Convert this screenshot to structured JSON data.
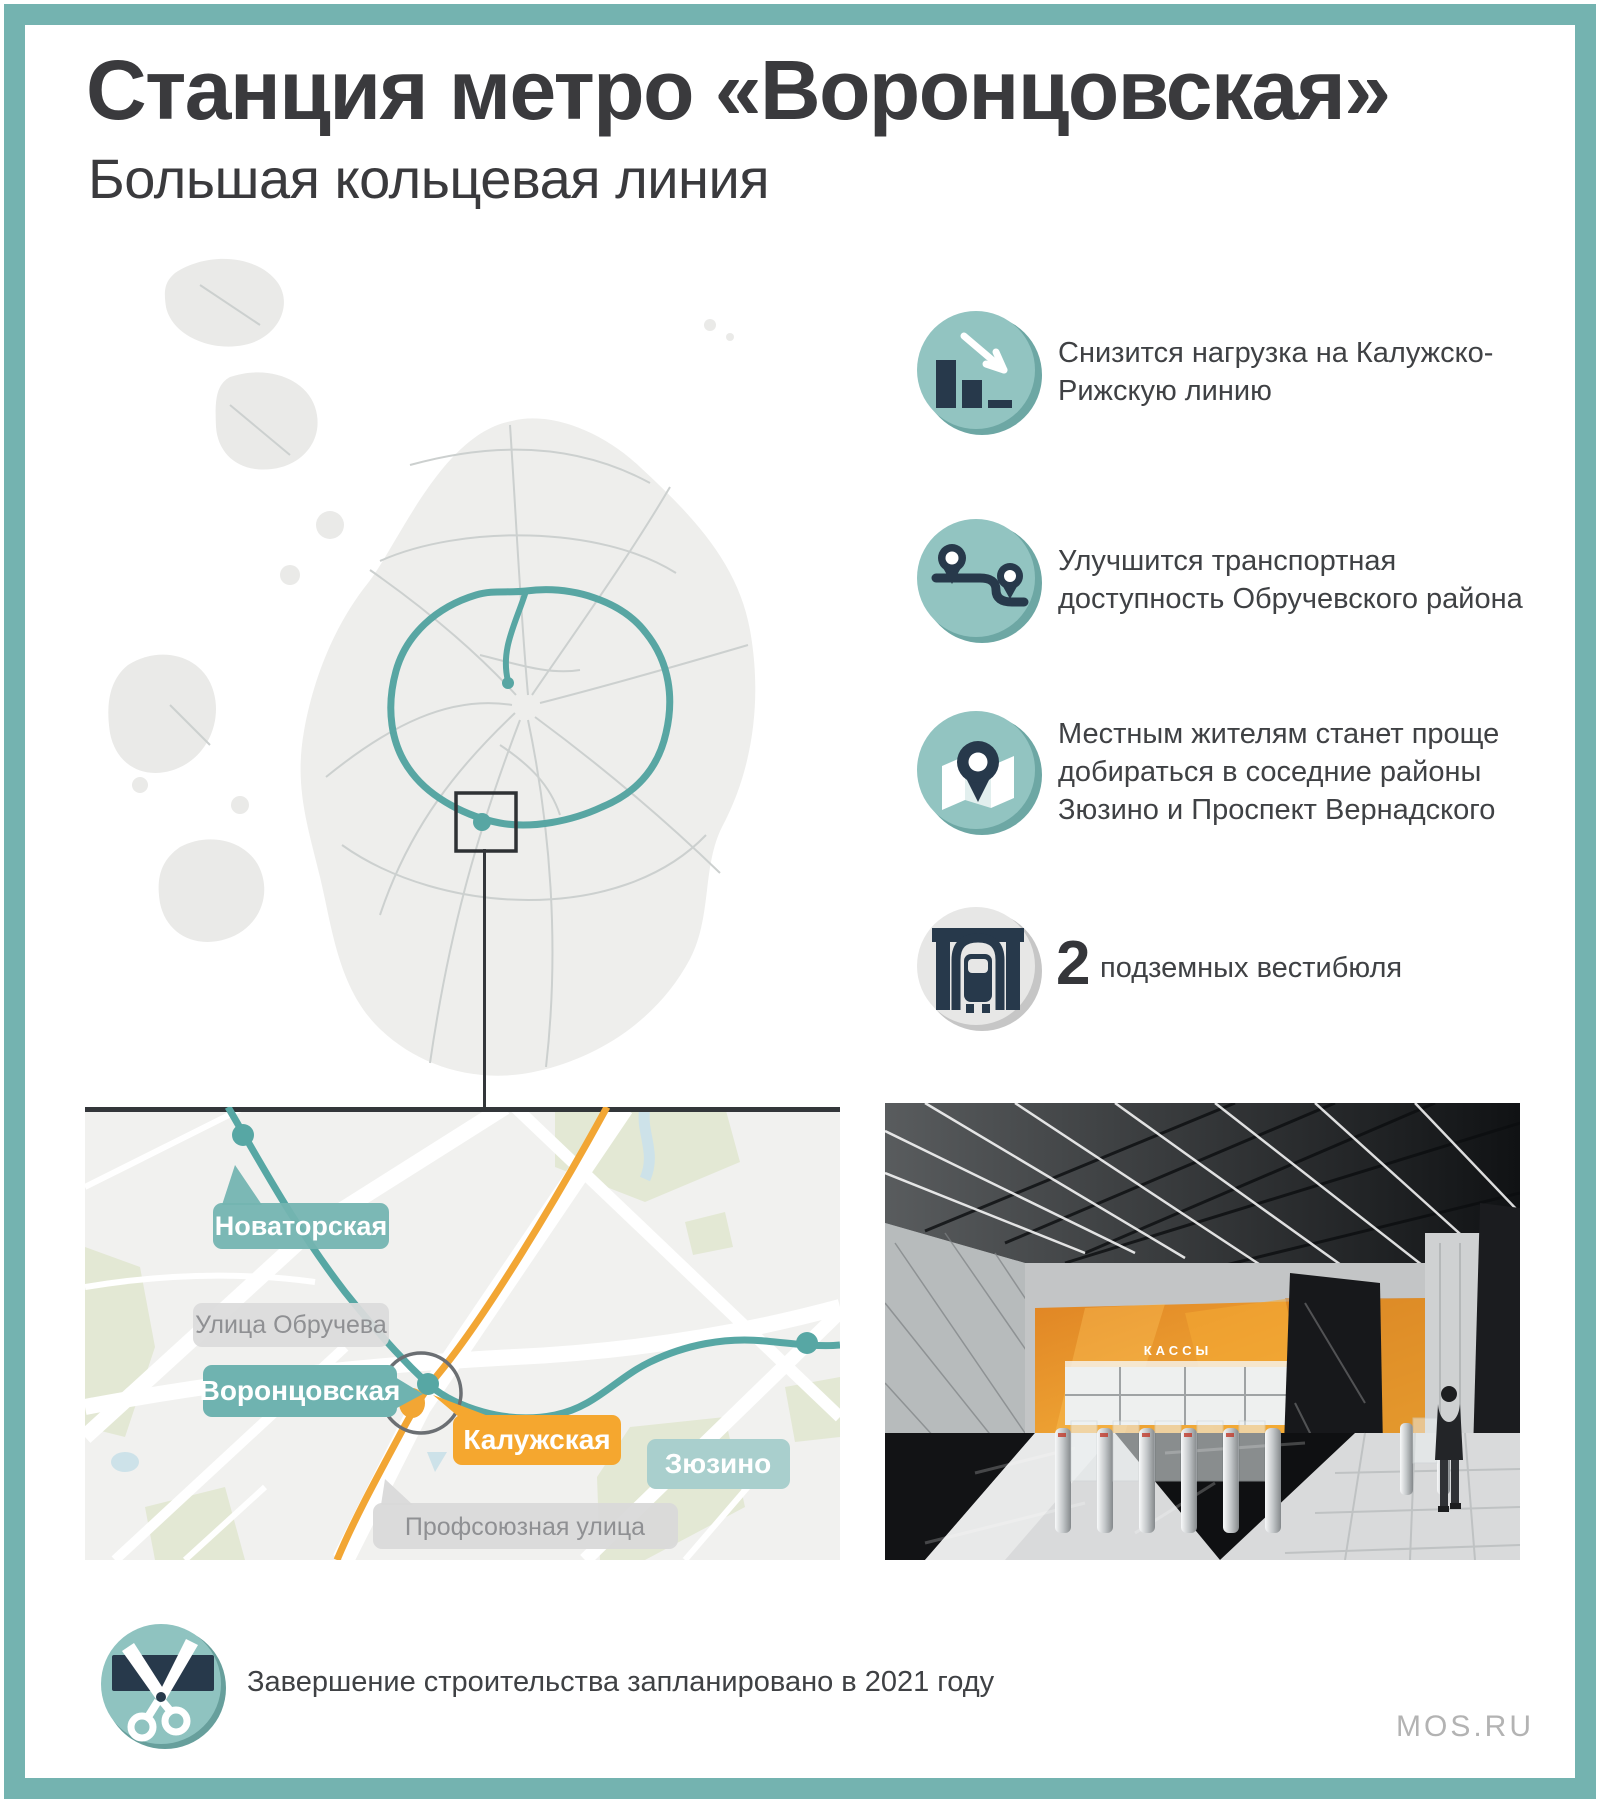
{
  "header": {
    "title": "Станция метро «Воронцовская»",
    "subtitle": "Большая кольцевая линия"
  },
  "colors": {
    "accent_teal": "#74b3b0",
    "line_teal": "#58a6a3",
    "line_orange": "#f2a634",
    "icon_navy": "#27394b",
    "label_gray": "#d9d9d9",
    "text_dark": "#3a3a3d"
  },
  "benefits": [
    {
      "icon": "bar-chart-decline-icon",
      "lines": [
        "Снизится нагрузка на Калужско-",
        "Рижскую линию"
      ]
    },
    {
      "icon": "route-pins-icon",
      "lines": [
        "Улучшится транспортная",
        "доступность Обручевского района"
      ]
    },
    {
      "icon": "map-pin-icon",
      "lines": [
        "Местным жителям станет проще",
        "добираться в соседние районы",
        "Зюзино и Проспект Вернадского"
      ]
    },
    {
      "icon": "tunnel-train-icon",
      "value": "2",
      "label": "подземных вестибюля"
    }
  ],
  "detail_map": {
    "stations": [
      {
        "name": "Новаторская",
        "line": "bkl"
      },
      {
        "name": "Воронцовская",
        "line": "bkl"
      },
      {
        "name": "Калужская",
        "line": "kaluzhsko-rizhskaya"
      },
      {
        "name": "Зюзино",
        "line": "bkl"
      }
    ],
    "streets": [
      "Улица Обручева",
      "Профсоюзная улица"
    ]
  },
  "photo": {
    "sign": "КАССЫ",
    "caption_icon": "station-interior-render"
  },
  "footer": {
    "icon": "scissors-ribbon-icon",
    "note": "Завершение строительства запланировано в 2021 году",
    "brand": "MOS.RU"
  }
}
